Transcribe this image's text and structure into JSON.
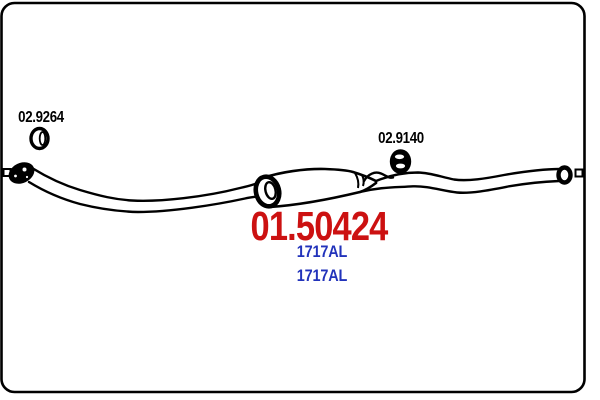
{
  "diagram": {
    "type": "exhaust-system-part-drawing",
    "labels": {
      "gasket_ref": "02.9264",
      "hanger_ref": "02.9140",
      "part_number": "01.50424",
      "oe_number_1": "1717AL",
      "oe_number_2": "1717AL"
    },
    "colors": {
      "background": "#ffffff",
      "line": "#000000",
      "label": "#000000",
      "part_number": "#cc1111",
      "oe_number": "#2233bb"
    },
    "icons": {
      "gasket": "gasket-ring-icon",
      "hanger": "rubber-hanger-icon"
    }
  }
}
